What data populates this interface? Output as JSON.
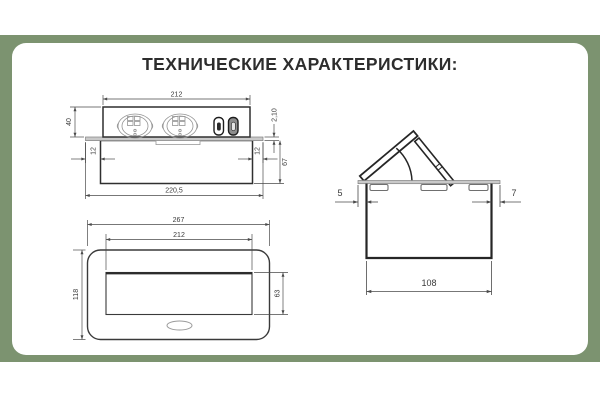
{
  "page": {
    "title": "ТЕХНИЧЕСКИЕ ХАРАКТЕРИСТИКИ:"
  },
  "colors": {
    "accent_green": "#7C9370",
    "card_background": "#FFFFFF",
    "outline_dark": "#2F2F2F",
    "dimension_line": "#4A4A4A",
    "flange_gray": "#C9C9C9"
  },
  "drawings": {
    "side_view": {
      "description": "pop-up socket block, side view",
      "dims": {
        "top_width": "212",
        "front_height": "40",
        "lid_thickness": "2,10",
        "left_inset": "12",
        "right_inset": "12",
        "box_depth": "67",
        "flange_width": "220,5"
      }
    },
    "top_view": {
      "description": "cover plate, top view",
      "dims": {
        "outer_width": "267",
        "cutout_width": "212",
        "outer_height": "118",
        "cutout_height": "63"
      }
    },
    "end_view": {
      "description": "mounting box with open lid, end view",
      "dims": {
        "left_overhang": "5",
        "right_overhang": "7",
        "box_width": "108"
      }
    }
  }
}
